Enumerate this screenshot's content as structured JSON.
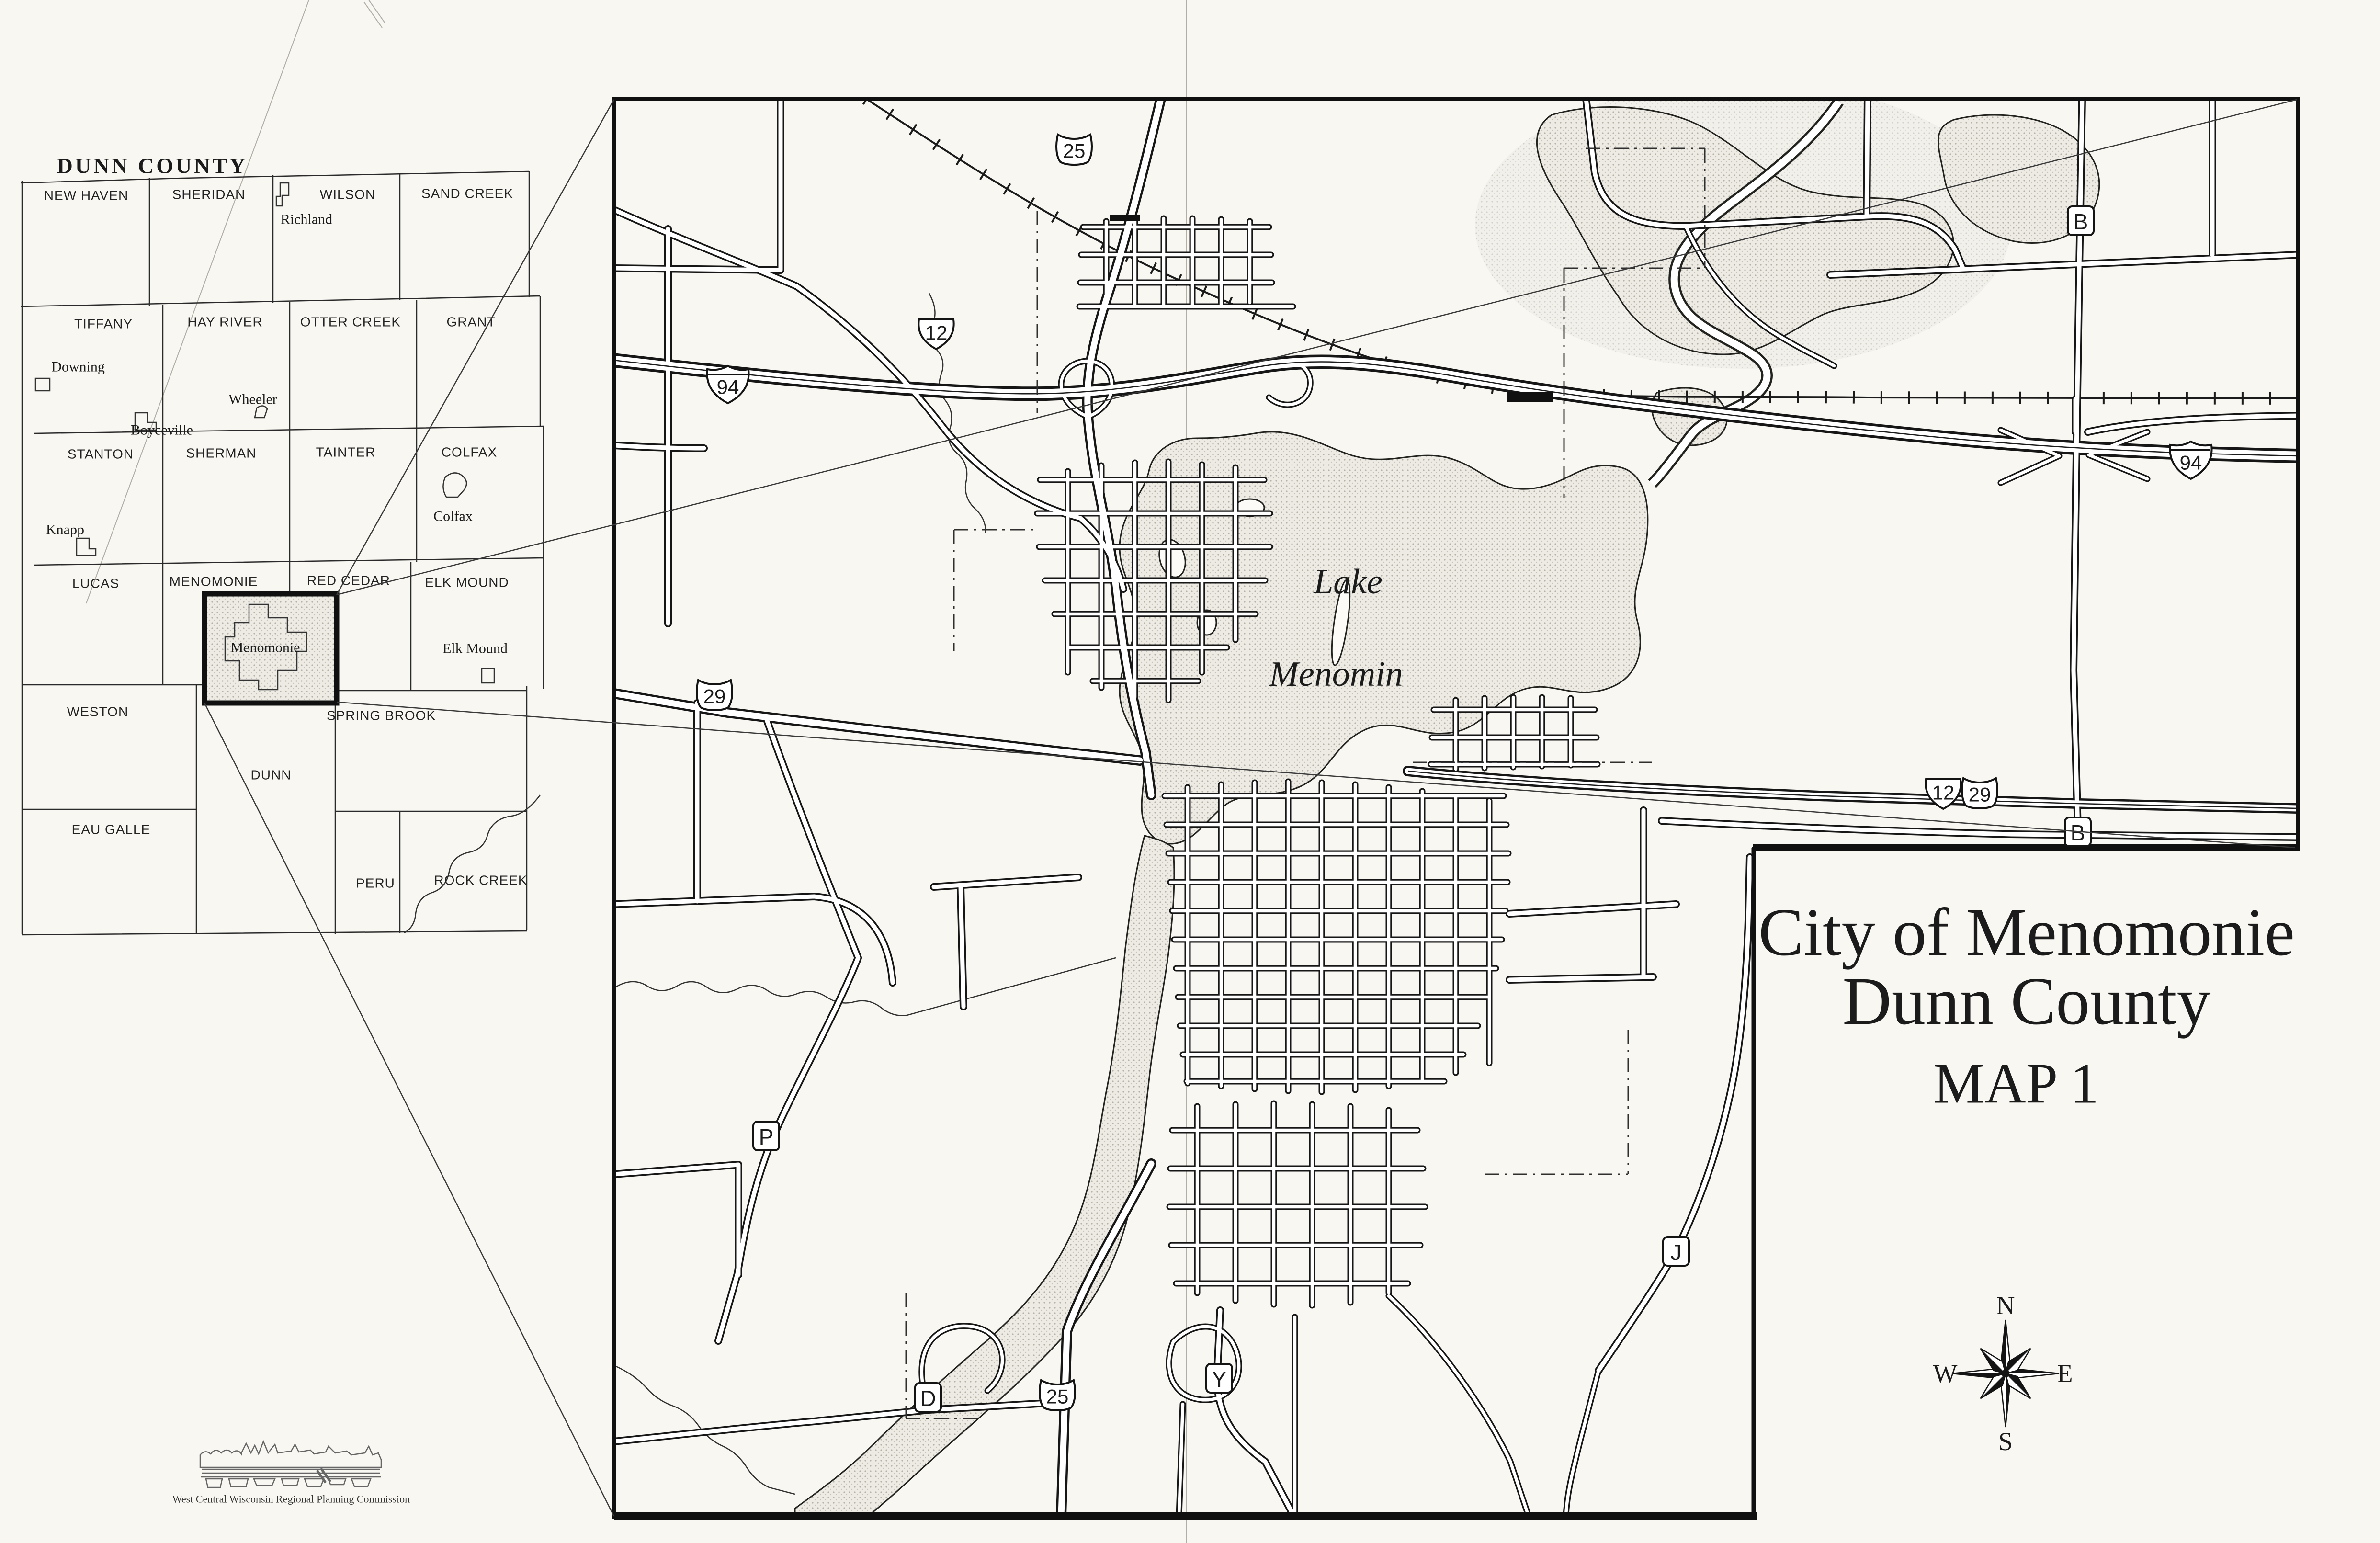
{
  "page": {
    "background": "#f8f7f2",
    "ink": "#1b1b1b"
  },
  "inset": {
    "title": "DUNN COUNTY",
    "townships": [
      {
        "name": "NEW HAVEN"
      },
      {
        "name": "SHERIDAN"
      },
      {
        "name": "WILSON"
      },
      {
        "name": "SAND CREEK"
      },
      {
        "name": "TIFFANY"
      },
      {
        "name": "HAY RIVER"
      },
      {
        "name": "OTTER CREEK"
      },
      {
        "name": "GRANT"
      },
      {
        "name": "STANTON"
      },
      {
        "name": "SHERMAN"
      },
      {
        "name": "TAINTER"
      },
      {
        "name": "COLFAX"
      },
      {
        "name": "LUCAS"
      },
      {
        "name": "MENOMONIE"
      },
      {
        "name": "RED CEDAR"
      },
      {
        "name": "ELK MOUND"
      },
      {
        "name": "WESTON"
      },
      {
        "name": "DUNN"
      },
      {
        "name": "SPRING BROOK"
      },
      {
        "name": "EAU GALLE"
      },
      {
        "name": "PERU"
      },
      {
        "name": "ROCK CREEK"
      }
    ],
    "villages": [
      {
        "name": "Richland"
      },
      {
        "name": "Downing"
      },
      {
        "name": "Wheeler"
      },
      {
        "name": "Boyceville"
      },
      {
        "name": "Knapp"
      },
      {
        "name": "Colfax"
      },
      {
        "name": "Menomonie"
      },
      {
        "name": "Elk Mound"
      }
    ]
  },
  "main_map": {
    "lake_label": {
      "line1": "Lake",
      "line2": "Menomin"
    },
    "shields": [
      {
        "type": "state",
        "label": "25"
      },
      {
        "type": "us",
        "label": "12"
      },
      {
        "type": "interstate",
        "label": "94"
      },
      {
        "type": "interstate",
        "label": "94"
      },
      {
        "type": "state",
        "label": "29"
      },
      {
        "type": "us",
        "label": "12"
      },
      {
        "type": "state",
        "label": "29"
      },
      {
        "type": "state",
        "label": "25"
      },
      {
        "type": "county",
        "label": "B"
      },
      {
        "type": "county",
        "label": "B"
      },
      {
        "type": "county",
        "label": "P"
      },
      {
        "type": "county",
        "label": "J"
      },
      {
        "type": "county",
        "label": "D"
      },
      {
        "type": "county",
        "label": "Y"
      }
    ]
  },
  "title_block": {
    "line1": "City of Menomonie",
    "line2": "Dunn County",
    "line3": "MAP 1"
  },
  "compass": {
    "north": "N",
    "south": "S",
    "east": "E",
    "west": "W"
  },
  "logo": {
    "caption": "West Central Wisconsin Regional Planning Commission"
  }
}
